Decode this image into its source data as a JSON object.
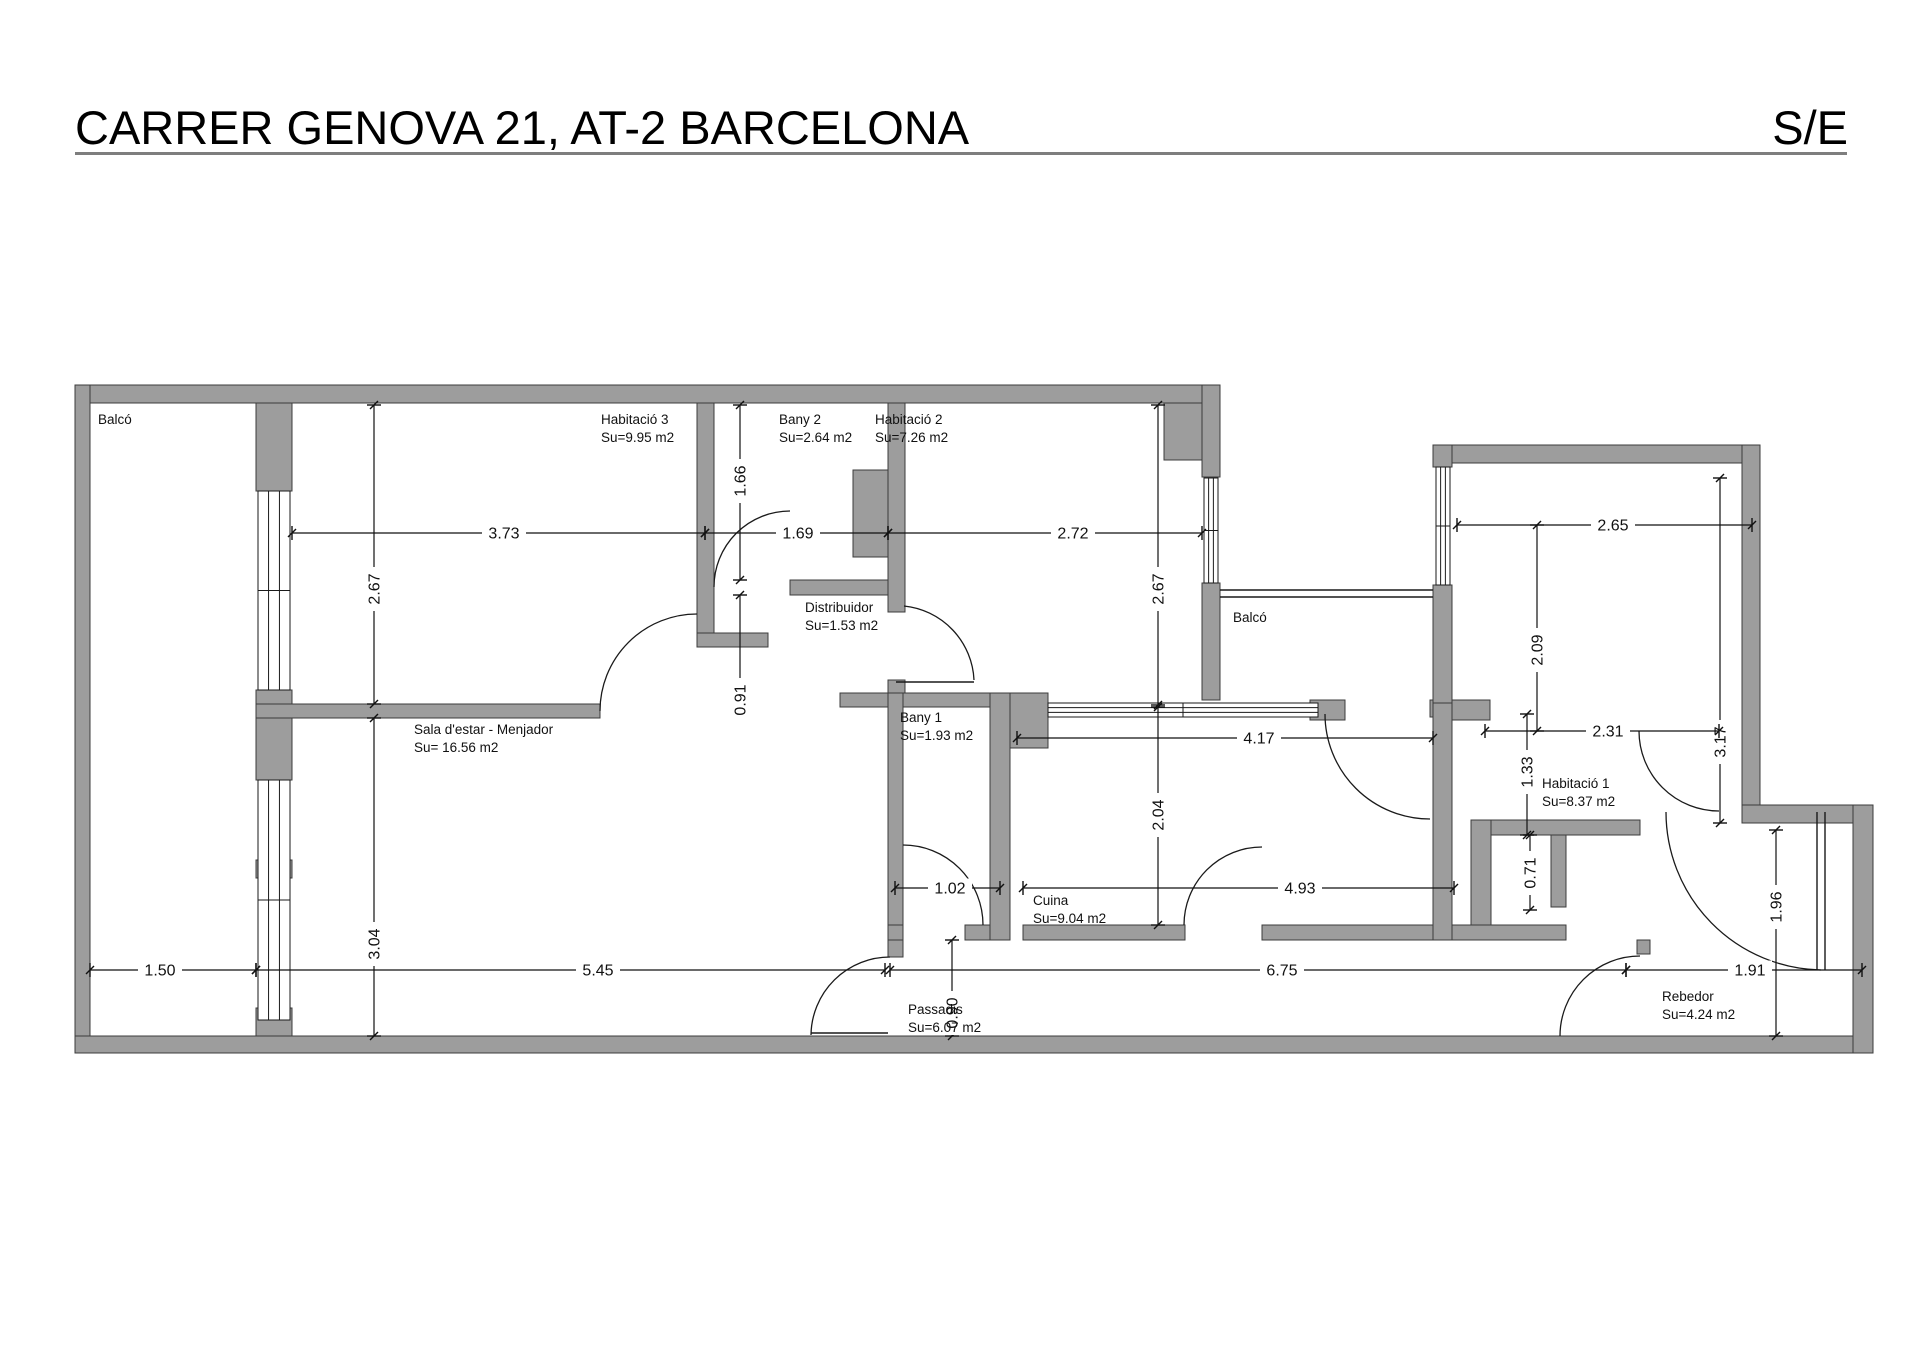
{
  "header": {
    "title": "CARRER GENOVA 21, AT-2 BARCELONA",
    "scale_label": "S/E"
  },
  "colors": {
    "wall_fill": "#9d9d9d",
    "wall_stroke": "#3c3c3c",
    "line": "#1a1a1a",
    "dim": "#111111"
  },
  "rooms": [
    {
      "name": "Balcó",
      "area": "",
      "x": 98,
      "y": 412
    },
    {
      "name": "Habitació 3",
      "area": "Su=9.95 m2",
      "x": 601,
      "y": 412
    },
    {
      "name": "Bany 2",
      "area": "Su=2.64 m2",
      "x": 779,
      "y": 412
    },
    {
      "name": "Habitació 2",
      "area": "Su=7.26 m2",
      "x": 875,
      "y": 412
    },
    {
      "name": "Distribuidor",
      "area": "Su=1.53 m2",
      "x": 805,
      "y": 600
    },
    {
      "name": "Balcó",
      "area": "",
      "x": 1233,
      "y": 610
    },
    {
      "name": "Sala d'estar - Menjador",
      "area": "Su= 16.56 m2",
      "x": 414,
      "y": 722
    },
    {
      "name": "Bany 1",
      "area": "Su=1.93 m2",
      "x": 900,
      "y": 710
    },
    {
      "name": "Cuina",
      "area": "Su=9.04 m2",
      "x": 1033,
      "y": 893
    },
    {
      "name": "Habitació 1",
      "area": "Su=8.37 m2",
      "x": 1542,
      "y": 776
    },
    {
      "name": "Passadis",
      "area": "Su=6.07 m2",
      "x": 908,
      "y": 1002
    },
    {
      "name": "Rebedor",
      "area": "Su=4.24 m2",
      "x": 1662,
      "y": 989
    }
  ],
  "dimensions": [
    {
      "v": "3.73",
      "x1": 292,
      "y1": 533,
      "x2": 705,
      "y2": 533,
      "lx": 504,
      "ly": 533,
      "rot": false
    },
    {
      "v": "1.69",
      "x1": 705,
      "y1": 533,
      "x2": 888,
      "y2": 533,
      "lx": 798,
      "ly": 533,
      "rot": false
    },
    {
      "v": "2.72",
      "x1": 888,
      "y1": 533,
      "x2": 1202,
      "y2": 533,
      "lx": 1073,
      "ly": 533,
      "rot": false
    },
    {
      "v": "2.67",
      "x1": 374,
      "y1": 405,
      "x2": 374,
      "y2": 704,
      "lx": 374,
      "ly": 589,
      "rot": true
    },
    {
      "v": "3.04",
      "x1": 374,
      "y1": 718,
      "x2": 374,
      "y2": 1036,
      "lx": 374,
      "ly": 944,
      "rot": true
    },
    {
      "v": "1.66",
      "x1": 740,
      "y1": 405,
      "x2": 740,
      "y2": 580,
      "lx": 740,
      "ly": 481,
      "rot": true
    },
    {
      "v": "0.91",
      "x1": 740,
      "y1": 595,
      "x2": 740,
      "y2": 693,
      "lx": 740,
      "ly": 700,
      "rot": true
    },
    {
      "v": "2.67",
      "x1": 1158,
      "y1": 405,
      "x2": 1158,
      "y2": 705,
      "lx": 1158,
      "ly": 589,
      "rot": true
    },
    {
      "v": "2.04",
      "x1": 1158,
      "y1": 707,
      "x2": 1158,
      "y2": 925,
      "lx": 1158,
      "ly": 815,
      "rot": true
    },
    {
      "v": "0.90",
      "x1": 952,
      "y1": 940,
      "x2": 952,
      "y2": 1036,
      "lx": 952,
      "ly": 1013,
      "rot": true
    },
    {
      "v": "4.17",
      "x1": 1017,
      "y1": 738,
      "x2": 1433,
      "y2": 738,
      "lx": 1259,
      "ly": 738,
      "rot": false
    },
    {
      "v": "1.02",
      "x1": 895,
      "y1": 888,
      "x2": 1000,
      "y2": 888,
      "lx": 950,
      "ly": 888,
      "rot": false
    },
    {
      "v": "4.93",
      "x1": 1023,
      "y1": 888,
      "x2": 1454,
      "y2": 888,
      "lx": 1300,
      "ly": 888,
      "rot": false
    },
    {
      "v": "2.65",
      "x1": 1457,
      "y1": 525,
      "x2": 1752,
      "y2": 525,
      "lx": 1613,
      "ly": 525,
      "rot": false
    },
    {
      "v": "2.09",
      "x1": 1537,
      "y1": 525,
      "x2": 1537,
      "y2": 731,
      "lx": 1537,
      "ly": 650,
      "rot": true
    },
    {
      "v": "3.17",
      "x1": 1720,
      "y1": 478,
      "x2": 1720,
      "y2": 823,
      "lx": 1720,
      "ly": 742,
      "rot": true
    },
    {
      "v": "2.31",
      "x1": 1485,
      "y1": 731,
      "x2": 1719,
      "y2": 731,
      "lx": 1608,
      "ly": 731,
      "rot": false
    },
    {
      "v": "1.33",
      "x1": 1527,
      "y1": 714,
      "x2": 1527,
      "y2": 835,
      "lx": 1527,
      "ly": 772,
      "rot": true
    },
    {
      "v": "0.71",
      "x1": 1530,
      "y1": 835,
      "x2": 1530,
      "y2": 910,
      "lx": 1530,
      "ly": 873,
      "rot": true
    },
    {
      "v": "1.96",
      "x1": 1776,
      "y1": 830,
      "x2": 1776,
      "y2": 1036,
      "lx": 1776,
      "ly": 907,
      "rot": true
    },
    {
      "v": "1.50",
      "x1": 90,
      "y1": 970,
      "x2": 256,
      "y2": 970,
      "lx": 160,
      "ly": 970,
      "rot": false
    },
    {
      "v": "5.45",
      "x1": 256,
      "y1": 970,
      "x2": 885,
      "y2": 970,
      "lx": 598,
      "ly": 970,
      "rot": false
    },
    {
      "v": "6.75",
      "x1": 890,
      "y1": 970,
      "x2": 1626,
      "y2": 970,
      "lx": 1282,
      "ly": 970,
      "rot": false
    },
    {
      "v": "1.91",
      "x1": 1626,
      "y1": 970,
      "x2": 1862,
      "y2": 970,
      "lx": 1750,
      "ly": 970,
      "rot": false
    }
  ],
  "walls": [
    [
      75,
      385,
      1145,
      18
    ],
    [
      75,
      385,
      15,
      668
    ],
    [
      75,
      1036,
      1798,
      17
    ],
    [
      256,
      403,
      36,
      88
    ],
    [
      256,
      690,
      36,
      90
    ],
    [
      256,
      860,
      36,
      18
    ],
    [
      256,
      1008,
      36,
      28
    ],
    [
      697,
      403,
      17,
      234
    ],
    [
      697,
      633,
      71,
      14
    ],
    [
      256,
      704,
      344,
      14
    ],
    [
      790,
      580,
      98,
      15
    ],
    [
      888,
      403,
      17,
      209
    ],
    [
      888,
      680,
      17,
      23
    ],
    [
      853,
      470,
      35,
      87
    ],
    [
      840,
      693,
      170,
      14
    ],
    [
      888,
      693,
      15,
      264
    ],
    [
      990,
      693,
      20,
      247
    ],
    [
      1010,
      693,
      38,
      55
    ],
    [
      888,
      925,
      15,
      15
    ],
    [
      965,
      925,
      25,
      15
    ],
    [
      1023,
      925,
      162,
      15
    ],
    [
      1262,
      925,
      192,
      15
    ],
    [
      1164,
      403,
      38,
      57
    ],
    [
      1202,
      385,
      18,
      92
    ],
    [
      1202,
      583,
      18,
      117
    ],
    [
      1310,
      700,
      35,
      20
    ],
    [
      1430,
      700,
      22,
      17
    ],
    [
      1433,
      445,
      327,
      18
    ],
    [
      1433,
      445,
      19,
      22
    ],
    [
      1433,
      585,
      19,
      135
    ],
    [
      1742,
      445,
      18,
      360
    ],
    [
      1742,
      805,
      131,
      18
    ],
    [
      1853,
      805,
      20,
      248
    ],
    [
      1433,
      703,
      19,
      237
    ],
    [
      1476,
      820,
      164,
      15
    ],
    [
      1471,
      820,
      20,
      105
    ],
    [
      1551,
      835,
      15,
      72
    ],
    [
      1452,
      925,
      114,
      15
    ],
    [
      1452,
      700,
      38,
      20
    ],
    [
      1637,
      940,
      13,
      14
    ]
  ],
  "windows": [
    {
      "x": 258,
      "y": 491,
      "w": 32,
      "h": 199,
      "o": "v"
    },
    {
      "x": 258,
      "y": 780,
      "w": 32,
      "h": 240,
      "o": "v"
    },
    {
      "x": 1204,
      "y": 478,
      "w": 14,
      "h": 105,
      "o": "v"
    },
    {
      "x": 1048,
      "y": 703,
      "w": 270,
      "h": 14,
      "o": "h"
    },
    {
      "x": 1436,
      "y": 467,
      "w": 14,
      "h": 118,
      "o": "v"
    }
  ],
  "doors": [
    "M 600 711 A 97 97 0 0 1 697 614",
    "M 714 587 A 76 76 0 0 1 790 511",
    "M 974 680 A 78 78 0 0 0 904 606",
    "M 890 957 A 79 79 0 0 0 811 1035",
    "M 903 845 A 80 80 0 0 1 983 925",
    "M 1262 847 A 78 78 0 0 0 1184 925",
    "M 1325 714 A 105 105 0 0 0 1430 819",
    "M 1639 731 A 80 80 0 0 0 1719 811",
    "M 1640 956 A 80 80 0 0 0 1560 1036",
    "M 1821 970 A 158 158 0 0 1 1666 812"
  ],
  "lines": [
    [
      1220,
      590,
      1433,
      590
    ],
    [
      1220,
      597,
      1433,
      597
    ],
    [
      896,
      682,
      974,
      682
    ],
    [
      811,
      1033,
      888,
      1033
    ],
    [
      1817,
      812,
      1817,
      970
    ],
    [
      1825,
      812,
      1825,
      970
    ]
  ]
}
